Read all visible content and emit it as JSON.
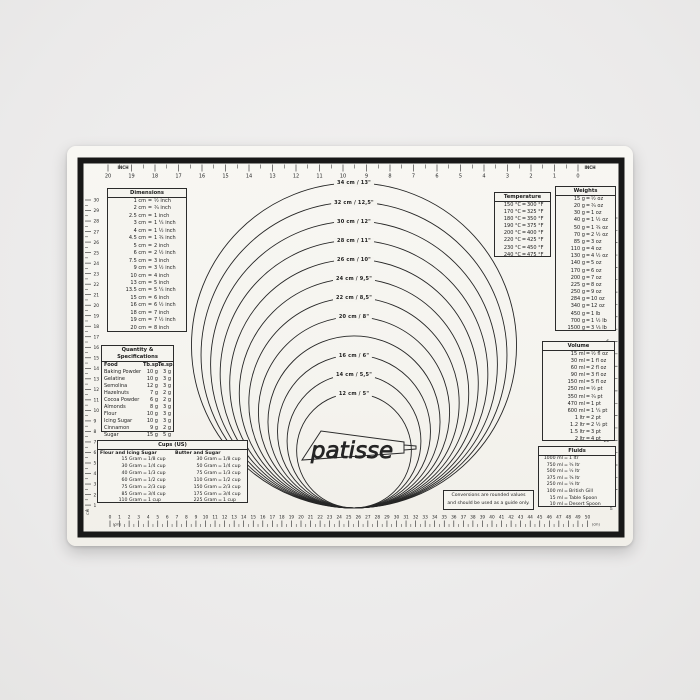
{
  "brand": {
    "name": "patisse"
  },
  "note": {
    "line1": "Conversions are rounded values",
    "line2": "and should be used as a guide only."
  },
  "rulers": {
    "top": {
      "unit_left": "INCH",
      "unit_right": "INCH",
      "values": [
        20,
        19,
        18,
        17,
        16,
        15,
        14,
        13,
        12,
        11,
        10,
        9,
        8,
        7,
        6,
        5,
        4,
        3,
        2,
        1,
        0
      ]
    },
    "bottom": {
      "unit_left": "(cm)",
      "unit_right": "(cm)",
      "values": [
        0,
        1,
        2,
        3,
        4,
        5,
        6,
        7,
        8,
        9,
        10,
        11,
        12,
        13,
        14,
        15,
        16,
        17,
        18,
        19,
        20,
        21,
        22,
        23,
        24,
        25,
        26,
        27,
        28,
        29,
        30,
        31,
        32,
        33,
        34,
        35,
        36,
        37,
        38,
        39,
        40,
        41,
        42,
        43,
        44,
        45,
        46,
        47,
        48,
        49,
        50
      ]
    },
    "left": {
      "unit": "CM",
      "values": [
        30,
        29,
        28,
        27,
        26,
        25,
        24,
        23,
        22,
        21,
        20,
        19,
        18,
        17,
        16,
        15,
        14,
        13,
        12,
        11,
        10,
        9,
        8,
        7,
        6,
        5,
        4,
        3,
        2,
        1
      ]
    },
    "right": {
      "unit": "INCH",
      "values": [
        1,
        2,
        3,
        4,
        5,
        6,
        7,
        8,
        9,
        10,
        11,
        12
      ]
    }
  },
  "circles": [
    {
      "cm": 34,
      "label": "34 cm / 13\""
    },
    {
      "cm": 32,
      "label": "32 cm / 12,5\""
    },
    {
      "cm": 30,
      "label": "30 cm / 12\""
    },
    {
      "cm": 28,
      "label": "28 cm / 11\""
    },
    {
      "cm": 26,
      "label": "26 cm / 10\""
    },
    {
      "cm": 24,
      "label": "24 cm / 9,5\""
    },
    {
      "cm": 22,
      "label": "22 cm / 8,5\""
    },
    {
      "cm": 20,
      "label": "20 cm / 8\""
    },
    {
      "cm": 18,
      "label": ""
    },
    {
      "cm": 16,
      "label": "16 cm / 6\""
    },
    {
      "cm": 14,
      "label": "14 cm / 5,5\""
    },
    {
      "cm": 12,
      "label": "12 cm / 5\""
    }
  ],
  "tables": {
    "dimensions": {
      "title": "Dimensions",
      "rows": [
        [
          "1 cm",
          "½ inch"
        ],
        [
          "2 cm",
          "¾ inch"
        ],
        [
          "2.5 cm",
          "1 inch"
        ],
        [
          "3 cm",
          "1 ¼ inch"
        ],
        [
          "4 cm",
          "1 ½ inch"
        ],
        [
          "4.5 cm",
          "1 ¾ inch"
        ],
        [
          "5 cm",
          "2 inch"
        ],
        [
          "6 cm",
          "2 ½ inch"
        ],
        [
          "7.5 cm",
          "3 inch"
        ],
        [
          "9 cm",
          "3 ½ inch"
        ],
        [
          "10 cm",
          "4 inch"
        ],
        [
          "13 cm",
          "5 inch"
        ],
        [
          "13.5 cm",
          "5 ¼ inch"
        ],
        [
          "15 cm",
          "6 inch"
        ],
        [
          "16 cm",
          "6 ½ inch"
        ],
        [
          "18 cm",
          "7 inch"
        ],
        [
          "19 cm",
          "7 ½ inch"
        ],
        [
          "20 cm",
          "8 inch"
        ]
      ]
    },
    "quantity": {
      "title": "Quantity & Specifications",
      "columns": [
        "Food",
        "Tb.sp.",
        "Te.sp."
      ],
      "rows": [
        [
          "Baking Powder",
          "10 g",
          "3 g"
        ],
        [
          "Gelatine",
          "10 g",
          "3 g"
        ],
        [
          "Semolina",
          "12 g",
          "3 g"
        ],
        [
          "Hazelnuts",
          "7 g",
          "2 g"
        ],
        [
          "Cocoa Powder",
          "6 g",
          "2 g"
        ],
        [
          "Almonds",
          "8 g",
          "3 g"
        ],
        [
          "Flour",
          "10 g",
          "3 g"
        ],
        [
          "Icing Sugar",
          "10 g",
          "3 g"
        ],
        [
          "Cinnamon",
          "9 g",
          "2 g"
        ],
        [
          "Sugar",
          "15 g",
          "5 g"
        ]
      ]
    },
    "cups": {
      "title": "Cups (US)",
      "groups": [
        {
          "title": "Flour and Icing Sugar",
          "rows": [
            [
              "15 Gram",
              "1/8 cup"
            ],
            [
              "30 Gram",
              "1/4 cup"
            ],
            [
              "40 Gram",
              "1/3 cup"
            ],
            [
              "60 Gram",
              "1/2 cup"
            ],
            [
              "75 Gram",
              "2/3 cup"
            ],
            [
              "85 Gram",
              "3/4 cup"
            ],
            [
              "110 Gram",
              "1 cup"
            ]
          ]
        },
        {
          "title": "Butter and Sugar",
          "rows": [
            [
              "30 Gram",
              "1/8 cup"
            ],
            [
              "50 Gram",
              "1/4 cup"
            ],
            [
              "75 Gram",
              "1/3 cup"
            ],
            [
              "110 Gram",
              "1/2 cup"
            ],
            [
              "150 Gram",
              "2/3 cup"
            ],
            [
              "175 Gram",
              "3/4 cup"
            ],
            [
              "225 Gram",
              "1 cup"
            ]
          ]
        }
      ]
    },
    "temperature": {
      "title": "Temperature",
      "rows": [
        [
          "150 °C",
          "300 °F"
        ],
        [
          "170 °C",
          "325 °F"
        ],
        [
          "180 °C",
          "350 °F"
        ],
        [
          "190 °C",
          "375 °F"
        ],
        [
          "200 °C",
          "400 °F"
        ],
        [
          "220 °C",
          "425 °F"
        ],
        [
          "230 °C",
          "450 °F"
        ],
        [
          "240 °C",
          "475 °F"
        ]
      ]
    },
    "weights": {
      "title": "Weights",
      "rows": [
        [
          "15 g",
          "½ oz"
        ],
        [
          "20 g",
          "¾ oz"
        ],
        [
          "30 g",
          "1 oz"
        ],
        [
          "40 g",
          "1 ½ oz"
        ],
        [
          "50 g",
          "1 ¾ oz"
        ],
        [
          "70 g",
          "2 ½ oz"
        ],
        [
          "85 g",
          "3 oz"
        ],
        [
          "110 g",
          "4 oz"
        ],
        [
          "130 g",
          "4 ½ oz"
        ],
        [
          "140 g",
          "5 oz"
        ],
        [
          "170 g",
          "6 oz"
        ],
        [
          "200 g",
          "7 oz"
        ],
        [
          "225 g",
          "8 oz"
        ],
        [
          "250 g",
          "9 oz"
        ],
        [
          "284 g",
          "10 oz"
        ],
        [
          "340 g",
          "12 oz"
        ],
        [
          "450 g",
          "1 lb"
        ],
        [
          "700 g",
          "1 ½ lb"
        ],
        [
          "1500 g",
          "3 ⅓ lb"
        ]
      ]
    },
    "volume": {
      "title": "Volume",
      "rows": [
        [
          "15 ml",
          "½ fl oz"
        ],
        [
          "30 ml",
          "1 fl oz"
        ],
        [
          "60 ml",
          "2 fl oz"
        ],
        [
          "90 ml",
          "3 fl oz"
        ],
        [
          "150 ml",
          "5 fl oz"
        ],
        [
          "250 ml",
          "½ pt"
        ],
        [
          "350 ml",
          "¾ pt"
        ],
        [
          "470 ml",
          "1 pt"
        ],
        [
          "600 ml",
          "1 ¼ pt"
        ],
        [
          "1 ltr",
          "2 pt"
        ],
        [
          "1.2 ltr",
          "2 ½ pt"
        ],
        [
          "1.5 ltr",
          "3 pt"
        ],
        [
          "2 ltr",
          "4 pt"
        ]
      ]
    },
    "fluids": {
      "title": "Fluids",
      "rows": [
        [
          "1000 ml",
          "1 ltr"
        ],
        [
          "750 ml",
          "¾ ltr"
        ],
        [
          "500 ml",
          "½ ltr"
        ],
        [
          "375 ml",
          "⅜ ltr"
        ],
        [
          "250 ml",
          "¼ ltr"
        ],
        [
          "100 ml",
          "British Gill"
        ],
        [
          "15 ml",
          "Table Spoon"
        ],
        [
          "10 ml",
          "Desert Spoon"
        ]
      ]
    }
  }
}
